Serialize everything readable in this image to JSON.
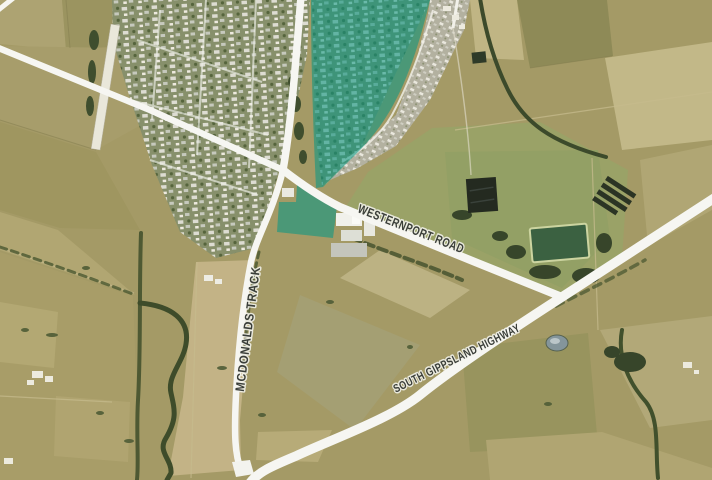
{
  "map": {
    "type": "aerial-satellite",
    "road_labels": [
      {
        "id": "westernport-road",
        "text": "WESTERNPORT ROAD"
      },
      {
        "id": "mcdonalds-track",
        "text": "MCDONALDS TRACK"
      },
      {
        "id": "south-gippsland-highway",
        "text": "SOUTH GIPPSLAND HIGHWAY"
      }
    ],
    "highlight": {
      "color": "#0a9783",
      "opacity": "0.58"
    },
    "label_style": {
      "color": "#3a3e39",
      "halo": "#f5f5ef"
    }
  }
}
